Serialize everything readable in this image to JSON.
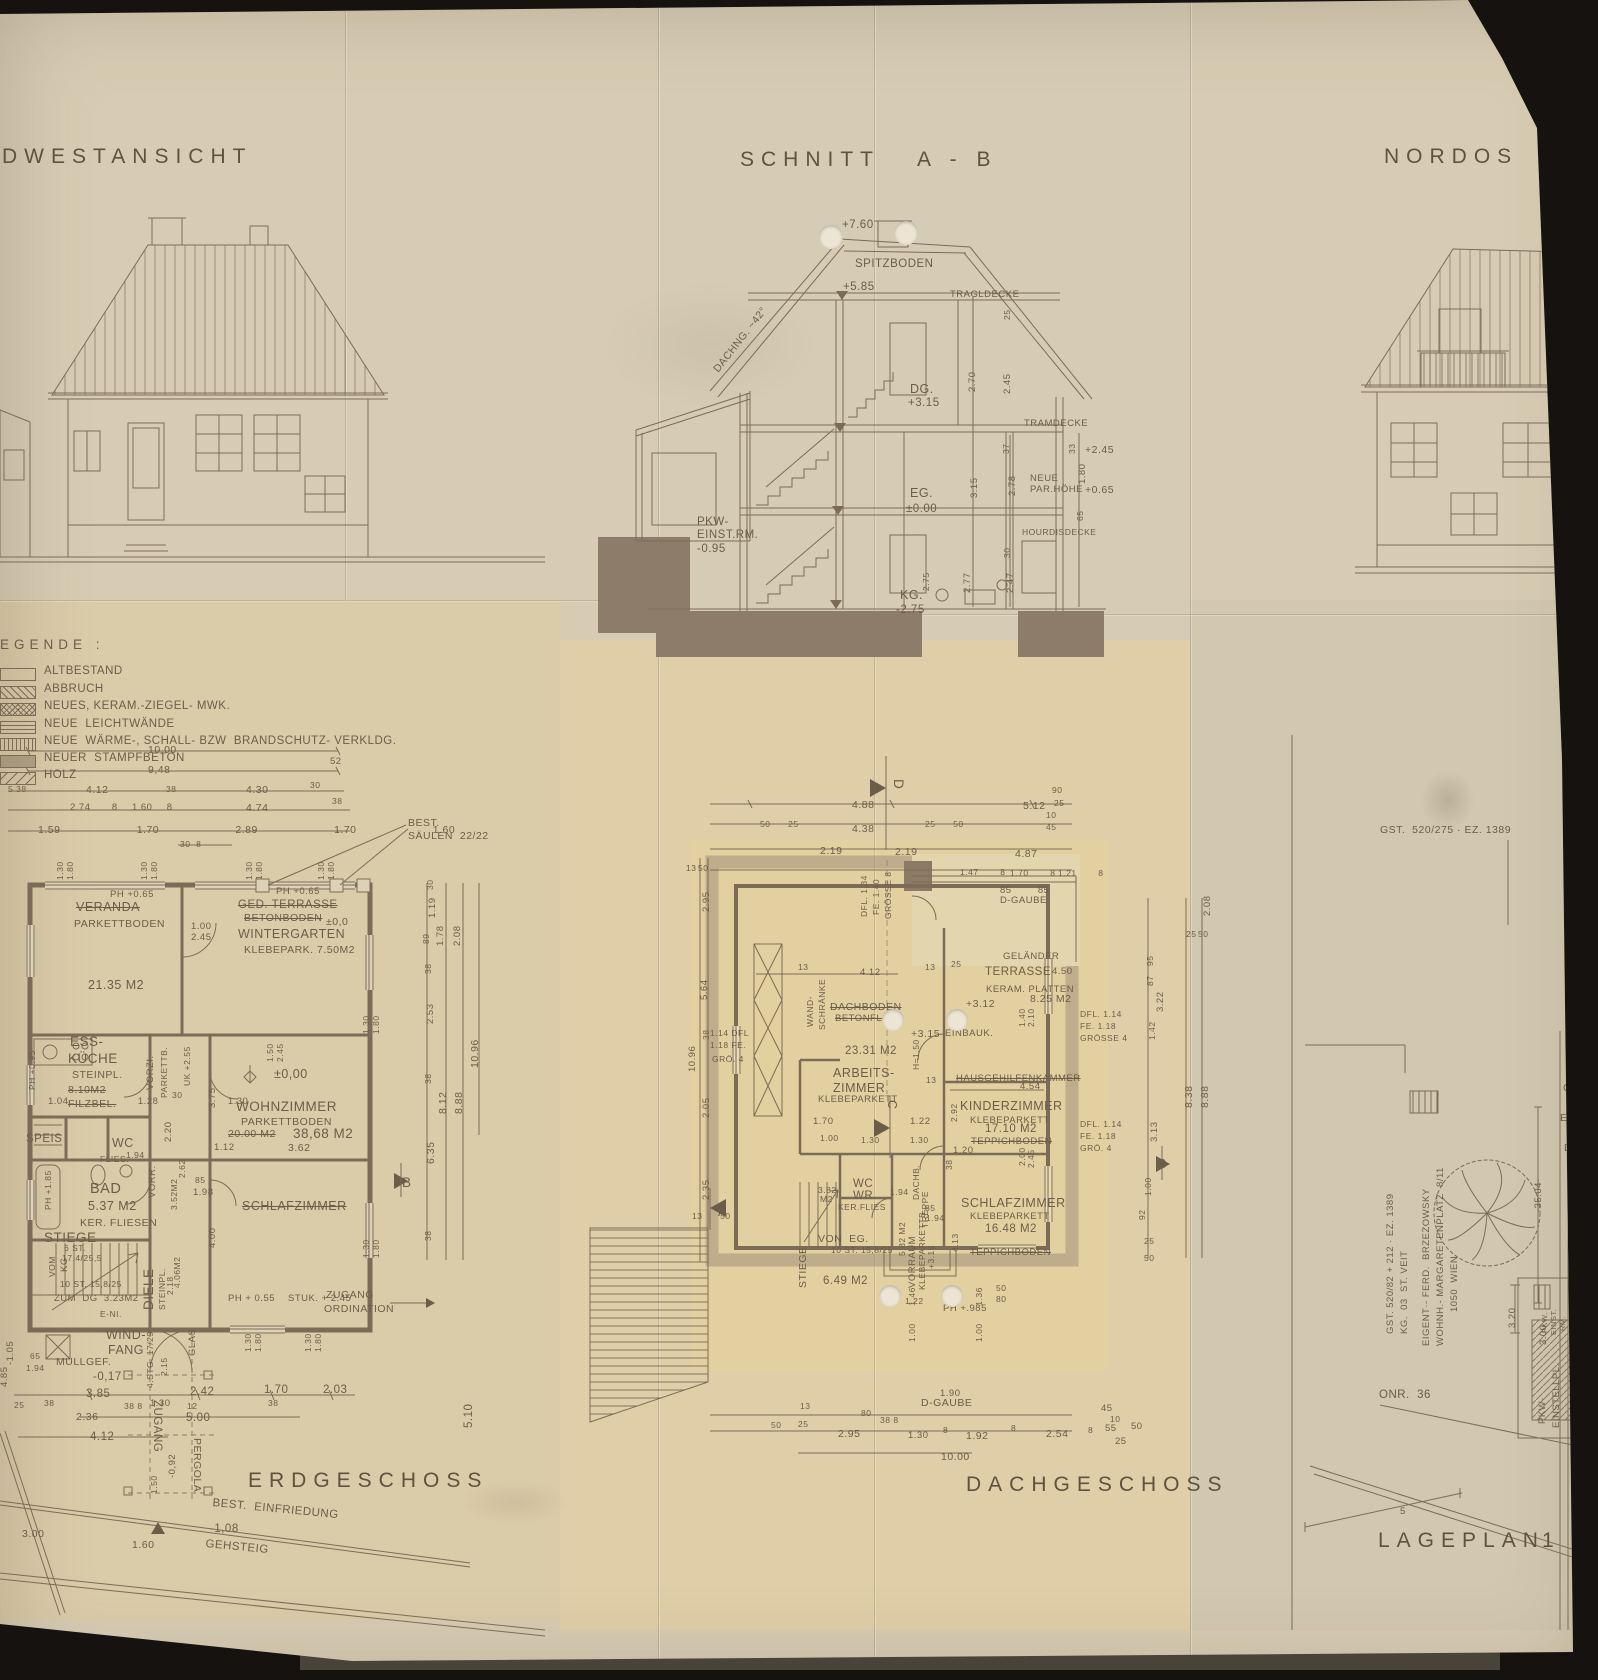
{
  "colors": {
    "paper": "#d7ccb3",
    "ink": "#6c5d4a",
    "line": "#7c6c57",
    "foundation": "#8d7c6a",
    "roof_band": "#a28e78"
  },
  "titles": {
    "southwest": "DWESTANSICHT",
    "section": "SCHNITT   A - B",
    "northeast": "NORDOS",
    "ground_floor": "ERDGESCHOSS",
    "attic_floor": "DACHGESCHOSS",
    "site_plan": "LAGEPLAN",
    "site_plan_scale": "1 ·"
  },
  "legend": {
    "heading": "EGENDE :",
    "items": [
      "ALTBESTAND",
      "ABBRUCH",
      "NEUES, KERAM.-ZIEGEL- MWK.",
      "NEUE  LEICHTWÄNDE",
      "NEUE  WÄRME-, SCHALL- BZW  BRANDSCHUTZ- VERKLDG.",
      "NEUER  STAMPFBETON",
      "HOLZ"
    ]
  },
  "sc": [
    "+7.60",
    "SPITZBODEN",
    "+5.85",
    "TRAGLDECKE",
    "25",
    "DACHNG. ~42°",
    "2.70",
    "2.45",
    "DG.",
    "+3.15",
    "TRAMDECKE",
    "37",
    "33",
    "+2.45",
    "NEUE",
    "PAR.HÖHE",
    "+0.65",
    "3.15",
    "2.78",
    "1.80",
    "65",
    "EG.",
    "±0.00",
    "PKW-",
    "EINST.RM.",
    "-0.95",
    "HOURDISDECKE",
    "30",
    "2.77",
    "2.47",
    "KG.",
    "-2.75",
    "2.75"
  ],
  "eg": [
    "10,00",
    "9,48",
    "52",
    "5 38",
    "4.12",
    "38",
    "4.30",
    "30",
    "2.74   8  1.60  8",
    "4.74",
    "38",
    "1.59   1.70   2.89   1.70   1.60",
    "30  8",
    "BEST.",
    "SÄULEN  22/22",
    "1.30",
    "1.80",
    "1.30",
    "1.80",
    "1.30",
    "1.80",
    "1.30",
    "1.80",
    "PH +0.65",
    "VERANDA",
    "PARKETTBODEN",
    "21.35 M2",
    "1.00",
    "2.45",
    "GED. TERRASSE",
    "BETONBODEN",
    "PH +0.65",
    "±0,0",
    "WINTERGARTEN",
    "KLEBEPARK. 7.50M2",
    "ESS-",
    "KÜCHE",
    "STEINPL.",
    "8.10M2",
    "FILZBEL.",
    "PH +0.95",
    "VORZI.",
    "PARKETTB.",
    "UK +2.55",
    "1.50",
    "2.45",
    "±0,00",
    "1.04   1.28   1.30",
    "30",
    "3.75",
    "WOHNZIMMER",
    "PARKETTBODEN",
    "20.00 M2",
    "38,68 M2",
    "1.12",
    "3.62",
    "SPEIS",
    "WC",
    "1.94",
    "FLIES.",
    "2.20",
    "VORR.",
    "3.52M2",
    "2.62",
    "85",
    "1.98",
    "BAD",
    "5.37 M2",
    "KER. FLIESEN",
    "PH +1.85",
    "SCHLAFZIMMER",
    "4.00",
    "STIEGE",
    "VOM",
    "KG",
    "6 ST.",
    "17,4/25,5",
    "10 ST. 15,8/25",
    "ZUM  DG  3.23M2",
    "DIELE",
    "STEINPL.",
    "2.18",
    "4.06M2",
    "E-NI.",
    "WIND-",
    "FANG",
    "MÜLLGEF.",
    "-0,17",
    "GLAS",
    "4.STG. 17/29",
    "2.15",
    "65",
    "1.94",
    "-1.05",
    "4.85",
    "25",
    "38",
    "3.85",
    "2.42",
    "1.70",
    "2.03",
    "38 8",
    "1.30",
    "12",
    "5.00",
    "38",
    "2.36",
    "4.12",
    "ZUGANG",
    "PERGOLA",
    "-0,92",
    "1.50",
    "BEST.  EINFRIEDUNG",
    "-1,08",
    "GEHSTEIG",
    "1.60",
    "3.00",
    "5.10",
    "ZUGANG",
    "ORDINATION",
    "PH + 0.55",
    "STUK. + 2.45",
    "1.30",
    "1.80",
    "1.30",
    "1.80",
    "30",
    "1.19",
    "89",
    "1.78",
    "2.08",
    "38",
    "2.53",
    "1.30",
    "1.80",
    "38",
    "8.12",
    "8.88",
    "10.96",
    "6.35",
    "B",
    "38",
    "1.30",
    "1.80"
  ],
  "dg": [
    "4.88",
    "5.12",
    "50  25",
    "4.38",
    "25  50",
    "90",
    "25",
    "10",
    "45",
    "2.19",
    "2.19",
    "4.87",
    "1.47  8",
    "1.70  8",
    "1.21  8",
    "85  85",
    "D-GAUBE",
    "DFL. 1.34",
    "FE. 1.40",
    "GRÖSSE 8",
    "D",
    "13",
    "50",
    "2.95",
    "5.64",
    "10.96",
    "38",
    "2.05",
    "2.35",
    "13  50",
    "GELÄNDER",
    "TERRASSE",
    "4.50",
    "KERAM. PLATTEN",
    "8.25 M2",
    "+3.12",
    "1.40",
    "2.10",
    "13",
    "4.12",
    "13",
    "25",
    "WAND-",
    "SCHRÄNKE",
    "DACHBODEN",
    "BETONFLÖ",
    "+3.15",
    "23.31 M2",
    "EINBAUK.",
    "H=1.50",
    "1.14 DFL",
    "1.18 FE.",
    "GRÖ. 4",
    "ARBEITS-",
    "ZIMMER",
    "KLEBEPARKETT",
    "HAUSGEHILFENKAMMER",
    "4.54",
    "13",
    "KINDERZIMMER",
    "KLEBEPARKETT",
    "17.10 M2",
    "TEPPICHBODEN",
    "2.92",
    "1.70",
    "1.22",
    "1.00",
    "1.30",
    "1.30",
    "1.20",
    "2.00",
    "2.45",
    "38",
    "C",
    "WC",
    "WR",
    "KER.FLIES",
    "3.82",
    "M2",
    "1.94",
    "DACHB.",
    "TREPPE",
    "85",
    "1.94",
    "SCHLAFZIMMER",
    "KLEBEPARKETT",
    "16.48 M2",
    "TEPPICHBODEN",
    "4.13",
    "VON  EG.",
    "10 ST. 15,8/25",
    "STIEGE",
    "5.82 M2",
    "VORRAUM",
    "KLEBEPARKETTB.",
    "+3.15",
    "6.49 M2",
    "1.22",
    "PH +.985",
    "50",
    "80",
    "1.00  1.46",
    "1.00  1.36",
    "1.90",
    "D-GAUBE",
    "13",
    "25",
    "50",
    "80",
    "38 8",
    "2.95",
    "1.30",
    "8",
    "1.92",
    "8",
    "2.54",
    "8",
    "55",
    "45",
    "10",
    "50",
    "25",
    "10.00",
    "DFL. 1.14",
    "FE. 1.18",
    "GRÖSSE 4",
    "3.22",
    "1.42",
    "2.08",
    "25",
    "50",
    "95",
    "87",
    "DFL. 1.14",
    "FE. 1.18",
    "GRÖ. 4",
    "3.13",
    "B",
    "8.38",
    "8.88",
    "1.00",
    "92",
    "25",
    "50",
    "A"
  ],
  "lp": [
    "GST.  520/275 · EZ. 1389",
    "GST. 520/82 + 212 · EZ. 1389",
    "KG.  03  ST. VEIT",
    "EIGENT·- FERD.  BRZEZOWSKY",
    "WOHNH.- MARGARETENPLATZ  8/11",
    "1050  WIEN",
    "GS",
    "EZ",
    "EIG",
    "D",
    "DZ",
    "D",
    "-35.04-",
    "ONR.  36",
    "3.20",
    "3.00",
    "PKW.",
    "EINST.",
    "RM.",
    "PKW-",
    "EINSTELLPL.",
    "5"
  ]
}
